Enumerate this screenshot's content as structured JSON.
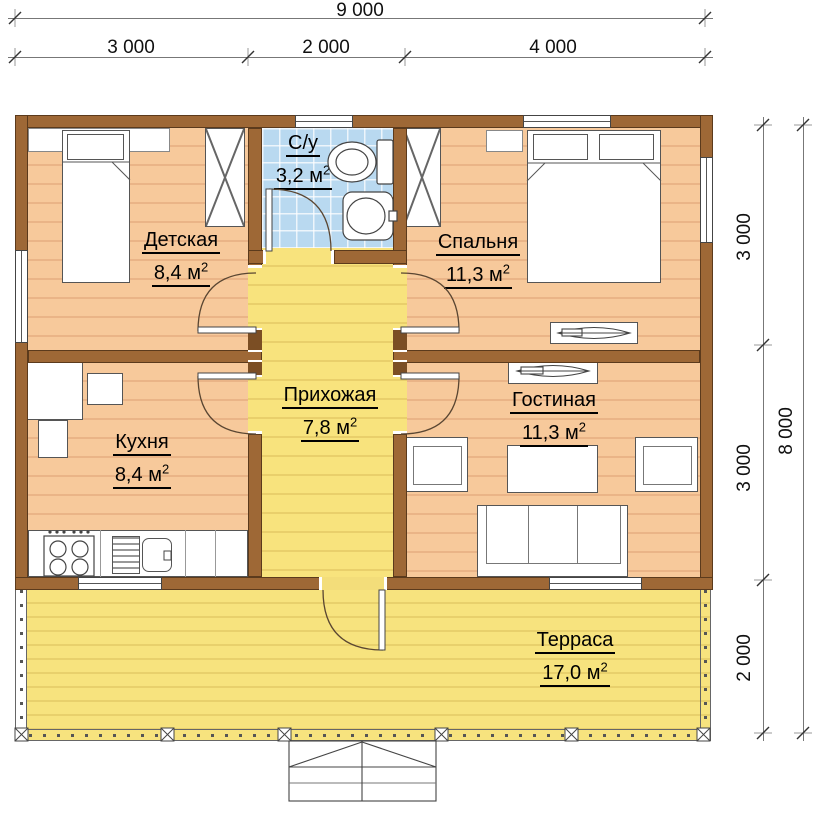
{
  "dimensions": {
    "top_total": "9 000",
    "top_segments": [
      "3 000",
      "2 000",
      "4 000"
    ],
    "right_segments": [
      "3 000",
      "3 000",
      "2 000"
    ],
    "right_total": "8 000"
  },
  "unit": {
    "meter": "м",
    "sup": "2"
  },
  "rooms": {
    "kids": {
      "name": "Детская",
      "area": "8,4"
    },
    "bathroom": {
      "name": "С/у",
      "area": "3,2"
    },
    "bedroom": {
      "name": "Спальня",
      "area": "11,3"
    },
    "hallway": {
      "name": "Прихожая",
      "area": "7,8"
    },
    "kitchen": {
      "name": "Кухня",
      "area": "8,4"
    },
    "living": {
      "name": "Гостиная",
      "area": "11,3"
    },
    "terrace": {
      "name": "Терраса",
      "area": "17,0"
    }
  },
  "colors": {
    "wall": "#9e6836",
    "wood_floor": "#f7c99b",
    "hall_floor": "#f8e37d",
    "terrace_floor": "#f7e37e",
    "bath_tile": "#b9d9f0"
  }
}
